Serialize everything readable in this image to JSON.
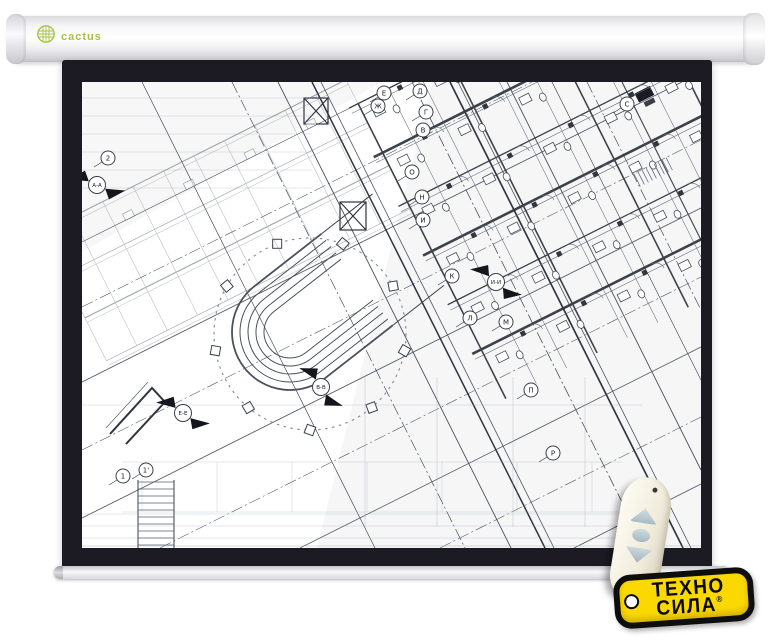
{
  "brand_logo": {
    "text": "cactus"
  },
  "brand_tag": {
    "line1": "ТЕХНО",
    "line2": "СИЛА",
    "reg": "®"
  },
  "colors": {
    "frame": "#1c1b24",
    "tag_yellow": "#fbd900",
    "logo_green": "#a6c43e",
    "button_blue": "#b7c8cf",
    "blueprint_ink": "#3a3f4a",
    "blueprint_light": "#9aa0ae"
  },
  "blueprint": {
    "axis_markers": [
      {
        "label": "Е",
        "x": 302,
        "y": 11
      },
      {
        "label": "Ж",
        "x": 296,
        "y": 24
      },
      {
        "label": "Д",
        "x": 338,
        "y": 9
      },
      {
        "label": "Г",
        "x": 344,
        "y": 30
      },
      {
        "label": "В",
        "x": 341,
        "y": 48
      },
      {
        "label": "О",
        "x": 330,
        "y": 90
      },
      {
        "label": "Н",
        "x": 340,
        "y": 115
      },
      {
        "label": "И",
        "x": 341,
        "y": 138
      },
      {
        "label": "К",
        "x": 370,
        "y": 194
      },
      {
        "label": "Л",
        "x": 388,
        "y": 236
      },
      {
        "label": "М",
        "x": 424,
        "y": 240
      },
      {
        "label": "П",
        "x": 449,
        "y": 308
      },
      {
        "label": "Р",
        "x": 471,
        "y": 371
      },
      {
        "label": "С",
        "x": 545,
        "y": 22
      },
      {
        "label": "2",
        "x": 26,
        "y": 76
      },
      {
        "label": "1",
        "x": 41,
        "y": 394
      },
      {
        "label": "1'",
        "x": 64,
        "y": 388
      }
    ],
    "section_markers": [
      {
        "label": "А-А",
        "x": 15,
        "y": 103,
        "angle": 205
      },
      {
        "label": "Е-Е",
        "x": 101,
        "y": 331,
        "angle": 215
      },
      {
        "label": "В-В",
        "x": 239,
        "y": 305,
        "angle": 235
      },
      {
        "label": "И-И",
        "x": 414,
        "y": 200,
        "angle": 220
      }
    ]
  }
}
